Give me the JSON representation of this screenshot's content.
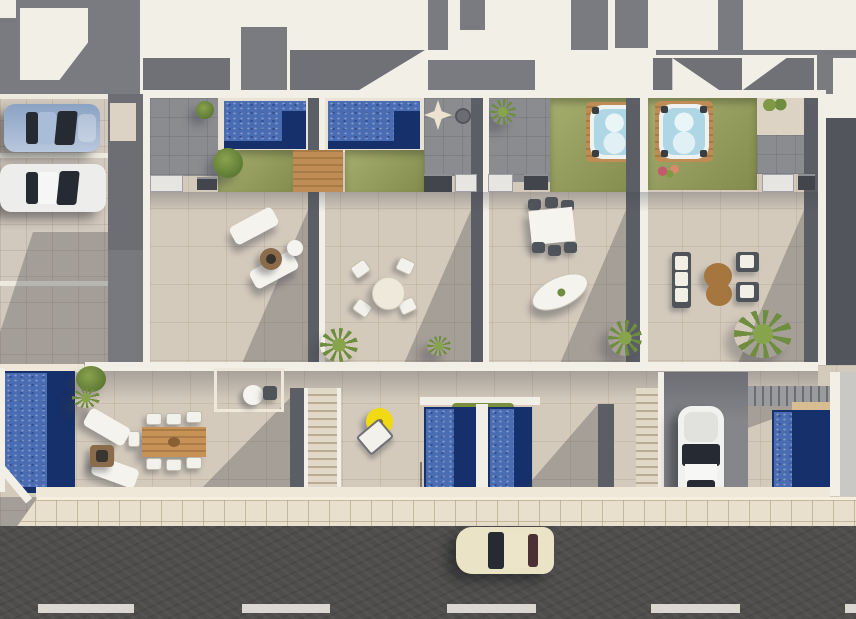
{
  "meta": {
    "title": "Aerial 3D render - row of four townhouses with roof terraces",
    "canvas": {
      "width": 856,
      "height": 619
    }
  },
  "palette": {
    "roof_white": "#f2efe7",
    "roof_gray": "#797b81",
    "wall_dark": "#5c5e65",
    "terrace_tile": "#d4cabc",
    "gray_tile": "#8b8c90",
    "lawn_green": "#99a35a",
    "pool_water": "#4a6cb2",
    "pool_deep": "#16306b",
    "hot_tub_water": "#aed6e4",
    "deck_wood": "#b9854e",
    "sidewalk": "#e9dfcd",
    "road_asphalt": "#4e4d4b",
    "lane_marking": "#e9e7df",
    "parking_paving": "#d2c9be",
    "street_car_cream": "#ebe3c6",
    "driveway_car_white": "#f1f1ef",
    "parked_car_blue": "#9db1cd",
    "parked_car_white": "#ededeb",
    "parasol_yellow": "#f2da12",
    "fire_pit_brown": "#8a6b4a",
    "plant_green": "#6f8d3f"
  },
  "scene": {
    "aria_label": "Top-down 3D architectural rendering of four attached townhouses: rooftop level with two swimming pools, lawns and two hot tubs, furnished tiled terraces below, ground-floor gardens with plunge pools and staircases, a parking area with a blue and a white car, a driveway with a white car, and a street with a cream car and dashed lane markings.",
    "units": [
      {
        "id": "unit-1",
        "rooftop": [
          "swimming-pool",
          "lawn",
          "wood-deck",
          "outdoor-kitchen"
        ],
        "terrace": [
          "sun-lounger",
          "sun-lounger",
          "side-table",
          "fire-bowl"
        ],
        "garden": [
          "swimming-pool",
          "wood-dining-table",
          "six-chairs",
          "two-sun-loungers",
          "fire-pit",
          "plants"
        ]
      },
      {
        "id": "unit-2",
        "rooftop": [
          "swimming-pool",
          "lawn",
          "wood-steps",
          "folded-parasol",
          "outdoor-kitchen"
        ],
        "terrace": [
          "round-dining-table",
          "four-chairs",
          "palm-plants"
        ],
        "garden": [
          "plunge-pool",
          "yellow-parasol-table",
          "sun-lounger",
          "hedge-planter"
        ]
      },
      {
        "id": "unit-3",
        "rooftop": [
          "hot-tub",
          "lawn",
          "tiled-patio",
          "palm-plant",
          "outdoor-kitchen"
        ],
        "terrace": [
          "rectangular-dining-table",
          "six-chairs",
          "oval-daybed",
          "palm-plant"
        ],
        "garden": [
          "plunge-pool",
          "staircase"
        ]
      },
      {
        "id": "unit-4",
        "rooftop": [
          "hot-tub",
          "lawn",
          "flowers",
          "tiled-patio",
          "outdoor-kitchen"
        ],
        "terrace": [
          "two-sofas",
          "figure-eight-coffee-table",
          "two-armchairs",
          "palm-trees"
        ],
        "garden": [
          "driveway",
          "white-car",
          "exterior-steps",
          "plunge-pool"
        ]
      }
    ],
    "vehicles": [
      {
        "id": "blue-car",
        "location": "parking-lot"
      },
      {
        "id": "white-car",
        "location": "parking-lot"
      },
      {
        "id": "white-hatchback",
        "location": "unit-4-driveway"
      },
      {
        "id": "cream-car",
        "location": "street"
      }
    ],
    "street": {
      "lane_dash_count": 5,
      "sidewalk": "tiled",
      "parking_stall_lines": 3
    }
  }
}
